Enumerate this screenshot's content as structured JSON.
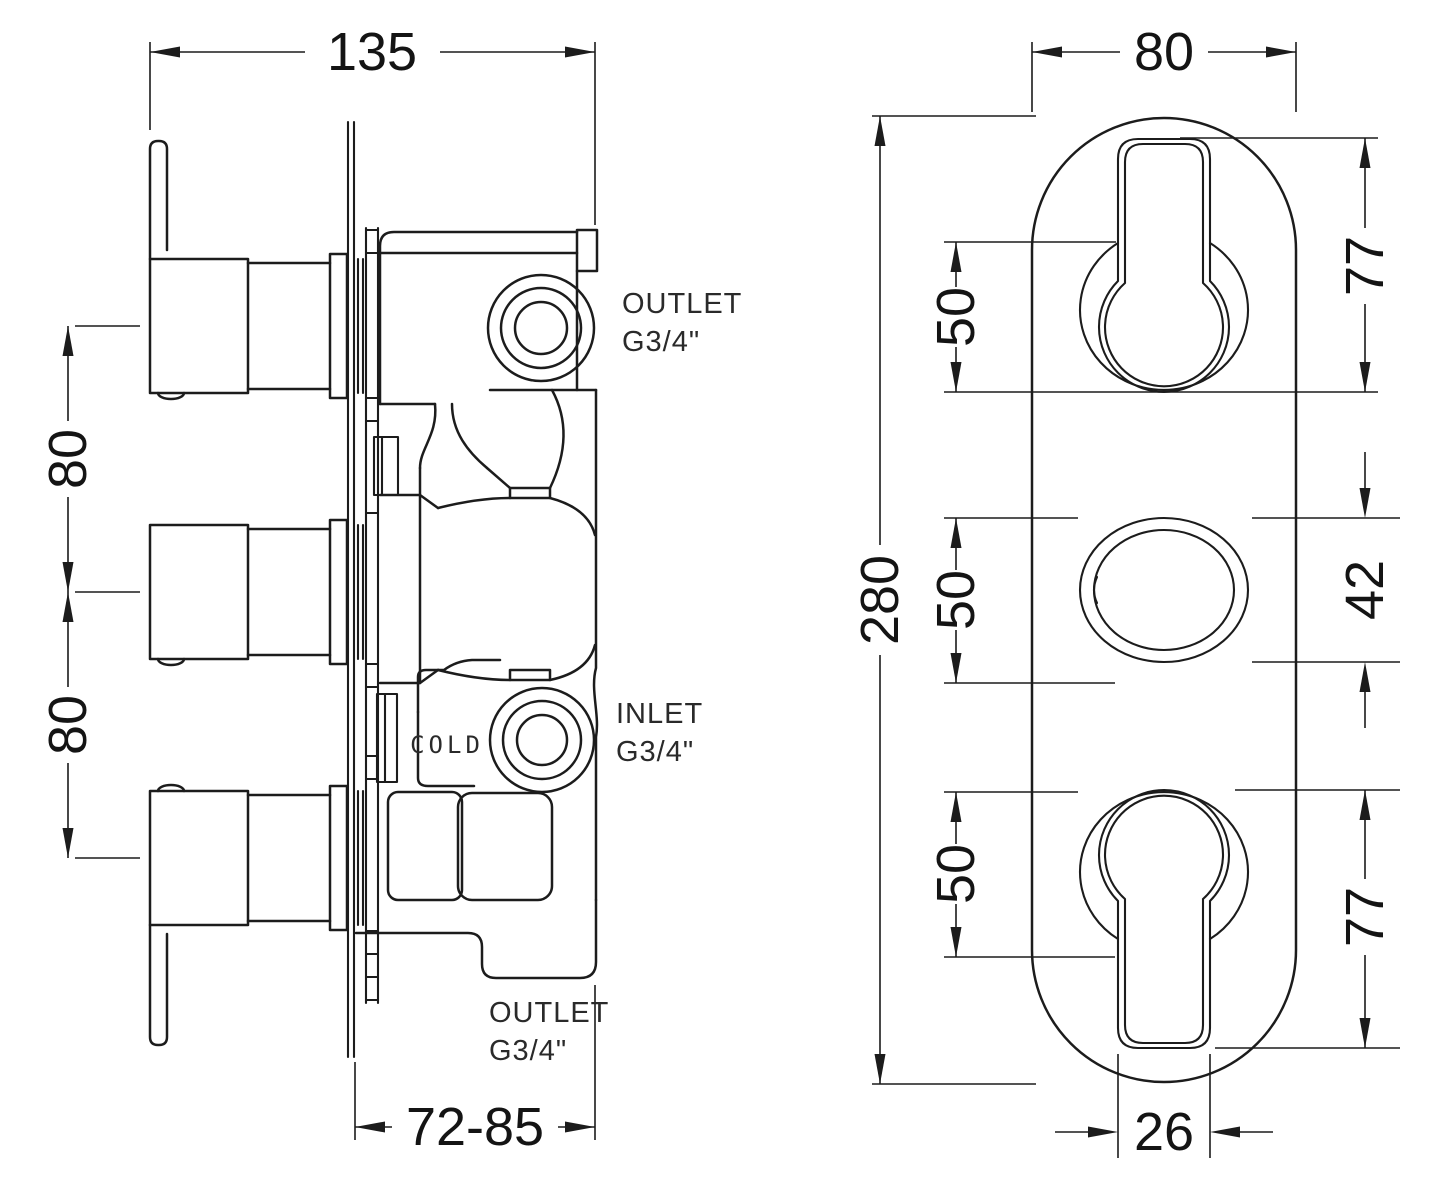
{
  "page": {
    "background": "#ffffff",
    "line_color": "#1c1c1c"
  },
  "left_view": {
    "name": "valve-side-elevation",
    "dims": {
      "overall_width": "135",
      "handle_spacing_upper": "80",
      "handle_spacing_lower": "80",
      "install_depth": "72-85"
    },
    "ports": {
      "outlet_top": {
        "line1": "OUTLET",
        "line2": "G3/4\""
      },
      "inlet": {
        "line1": "INLET",
        "line2": "G3/4\""
      },
      "outlet_bottom": {
        "line1": "OUTLET",
        "line2": "G3/4\""
      },
      "cold_marking": "COLD"
    }
  },
  "right_view": {
    "name": "faceplate-front-elevation",
    "dims": {
      "plate_width": "80",
      "plate_height": "280",
      "recess_top": "50",
      "recess_middle": "50",
      "recess_bottom": "50",
      "keyhole_top": "77",
      "oval_middle": "42",
      "keyhole_bottom": "77",
      "stem_width": "26"
    }
  }
}
